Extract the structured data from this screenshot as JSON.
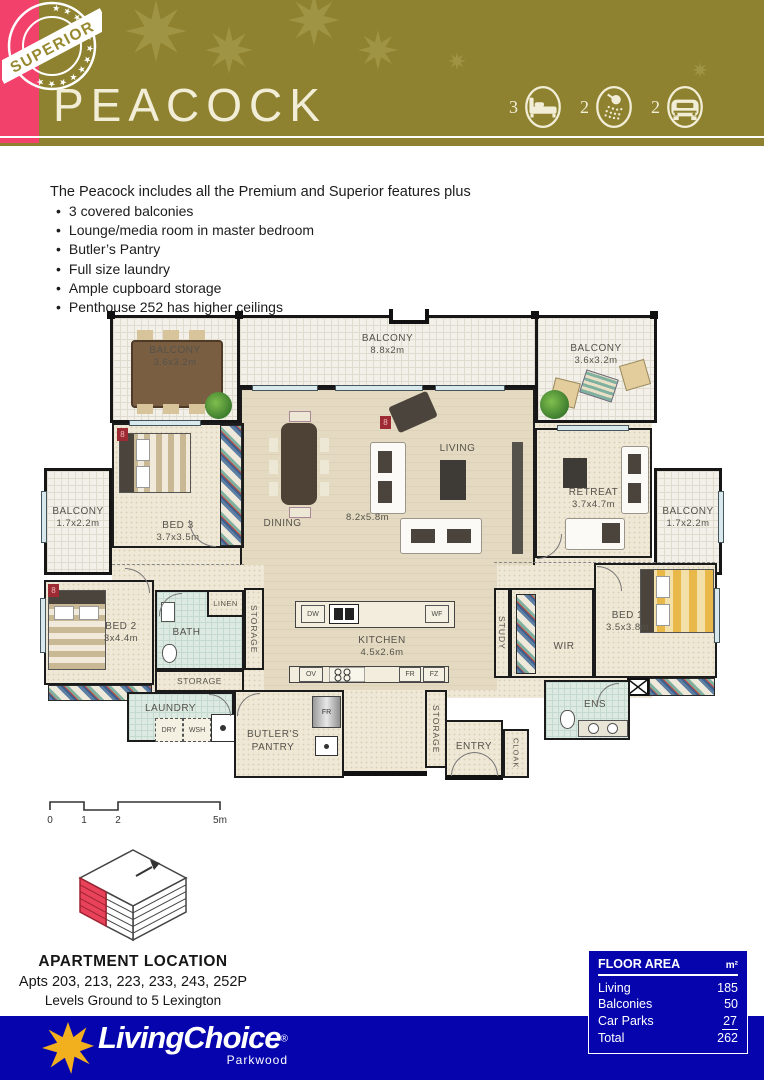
{
  "header": {
    "badge": "SUPERIOR",
    "badge_stars": "★ ★ ★ ★ ★ ★ ★ ★ ★ ★ ★ ★",
    "title": "PEACOCK",
    "stats": [
      {
        "icon": "bed-icon",
        "count": "3"
      },
      {
        "icon": "shower-icon",
        "count": "2"
      },
      {
        "icon": "car-icon",
        "count": "2"
      }
    ]
  },
  "features": {
    "intro": "The Peacock includes all the Premium and Superior features plus",
    "items": [
      "3 covered balconies",
      "Lounge/media room in master bedroom",
      "Butler’s Pantry",
      "Full size laundry",
      "Ample cupboard storage",
      "Penthouse 252 has higher ceilings"
    ]
  },
  "floorplan": {
    "rooms": {
      "balcony_top_left": {
        "label": "BALCONY",
        "dims": "3.6x3.2m"
      },
      "balcony_top_center": {
        "label": "BALCONY",
        "dims": "8.8x2m"
      },
      "balcony_top_right": {
        "label": "BALCONY",
        "dims": "3.6x3.2m"
      },
      "balcony_left": {
        "label": "BALCONY",
        "dims": "1.7x2.2m"
      },
      "balcony_right": {
        "label": "BALCONY",
        "dims": "1.7x2.2m"
      },
      "bed3": {
        "label": "BED 3",
        "dims": "3.7x3.5m"
      },
      "dining": {
        "label": "DINING"
      },
      "living": {
        "label": "LIVING",
        "dims": "8.2x5.8m"
      },
      "retreat": {
        "label": "RETREAT",
        "dims": "3.7x4.7m"
      },
      "bed2": {
        "label": "BED 2",
        "dims": "3x4.4m"
      },
      "bath": {
        "label": "BATH"
      },
      "linen": {
        "label": "LINEN"
      },
      "storage_hall": {
        "label": "STORAGE"
      },
      "kitchen": {
        "label": "KITCHEN",
        "dims": "4.5x2.6m"
      },
      "study": {
        "label": "STUDY"
      },
      "wir": {
        "label": "WIR"
      },
      "bed1": {
        "label": "BED 1",
        "dims": "3.5x3.8m"
      },
      "storage_lower": {
        "label": "STORAGE"
      },
      "laundry": {
        "label": "LAUNDRY"
      },
      "butlers_pantry": {
        "label": "BUTLER'S PANTRY"
      },
      "storage_entry": {
        "label": "STORAGE"
      },
      "entry": {
        "label": "ENTRY"
      },
      "cloak": {
        "label": "CLOAK"
      },
      "ens": {
        "label": "ENS"
      }
    },
    "appliances": {
      "dw": "DW",
      "wf": "WF",
      "ov": "OV",
      "fr": "FR",
      "fz": "FZ",
      "fr_pantry": "FR",
      "dry": "DRY",
      "wsh": "WSH"
    },
    "markers": {
      "unit": "8"
    }
  },
  "scalebar": {
    "ticks": [
      "0",
      "1",
      "2",
      "5m"
    ]
  },
  "location": {
    "title": "APARTMENT LOCATION",
    "apartments": "Apts 203, 213, 223, 233, 243, 252P",
    "levels": "Levels Ground to 5 Lexington"
  },
  "floor_area": {
    "title": "FLOOR AREA",
    "unit": "m²",
    "rows": [
      {
        "label": "Living",
        "value": "185"
      },
      {
        "label": "Balconies",
        "value": "50"
      },
      {
        "label": "Car Parks",
        "value": "27"
      },
      {
        "label": "Total",
        "value": "262"
      }
    ]
  },
  "footer": {
    "brand": "LivingChoice",
    "registered": "®",
    "location": "Parkwood"
  },
  "colors": {
    "olive": "#8E8230",
    "pink": "#F2426B",
    "blue": "#0604AC",
    "highlight_red": "#E8435A",
    "gold": "#F2B01E",
    "cream": "#F2EDD6"
  }
}
